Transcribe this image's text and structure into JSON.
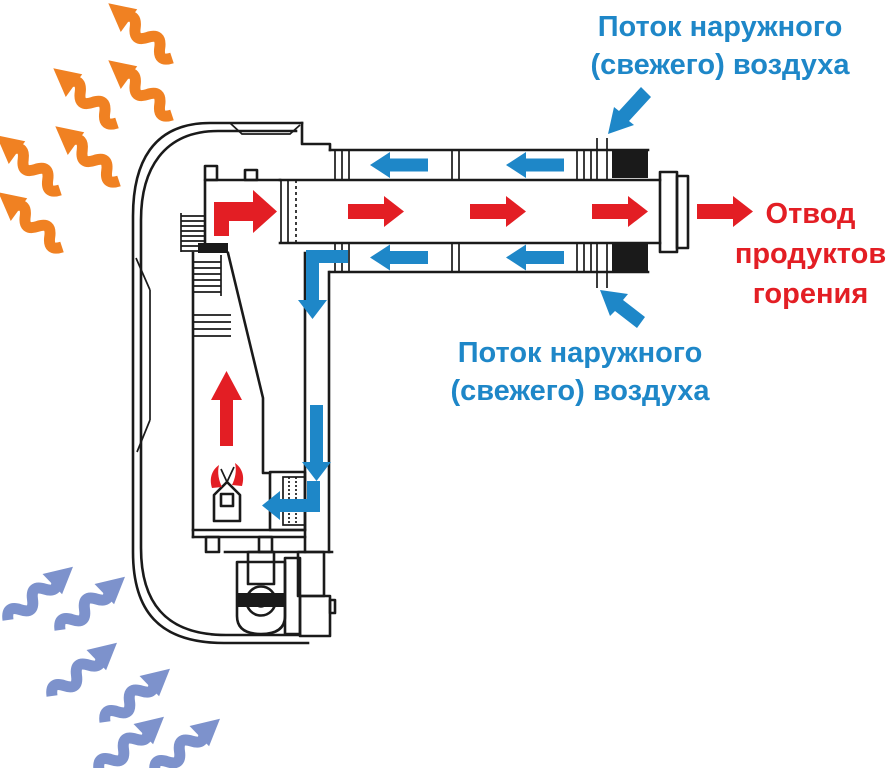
{
  "labels": {
    "fresh_air_top": {
      "line1": "Поток наружного",
      "line2": "(свежего) воздуха"
    },
    "fresh_air_bottom": {
      "line1": "Поток наружного",
      "line2": "(свежего) воздуха"
    },
    "exhaust": {
      "line1": "Отвод",
      "line2": "продуктов",
      "line3": "горения"
    }
  },
  "colors": {
    "fresh_air": "#1E87C8",
    "exhaust": "#E31E24",
    "warm_air": "#F08122",
    "room_air": "#7D92CC",
    "outline": "#1A1A1A",
    "background": "#FFFFFF"
  },
  "flows": [
    {
      "name": "warm-air-out",
      "color": "#F08122",
      "direction": "up-left",
      "arrow_count": 6,
      "style": "wavy"
    },
    {
      "name": "room-air-in",
      "color": "#7D92CC",
      "direction": "up-right",
      "arrow_count": 6,
      "style": "wavy"
    },
    {
      "name": "fresh-air-intake",
      "color": "#1E87C8",
      "direction": "into outer coaxial duct, down internal duct to burner"
    },
    {
      "name": "combustion-exhaust",
      "color": "#E31E24",
      "direction": "up from burner, out through inner flue pipe"
    }
  ]
}
